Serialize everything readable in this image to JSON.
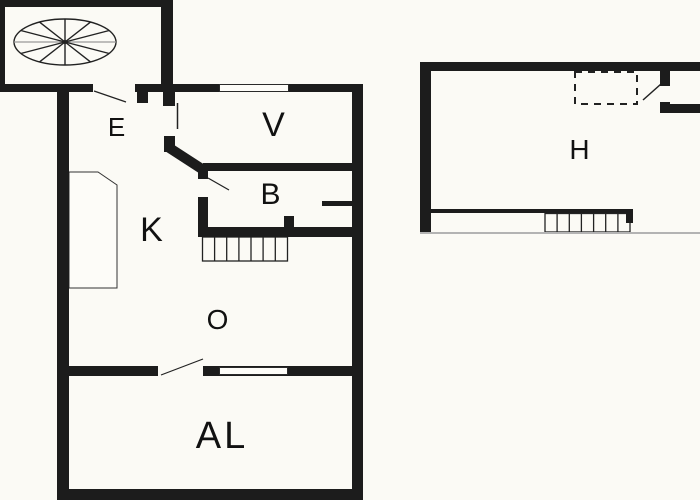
{
  "title": "Floor plan",
  "colors": {
    "wall": "#1c1c1c",
    "background": "#fbfaf5",
    "floor": "#fdfcf8",
    "thin_line": "#2a2a2a",
    "gray_line": "#b3b3b3",
    "label": "#111111"
  },
  "rooms": [
    {
      "label": "E"
    },
    {
      "label": "V"
    },
    {
      "label": "B"
    },
    {
      "label": "K"
    },
    {
      "label": "O"
    },
    {
      "label": "AL"
    },
    {
      "label": "H"
    }
  ]
}
